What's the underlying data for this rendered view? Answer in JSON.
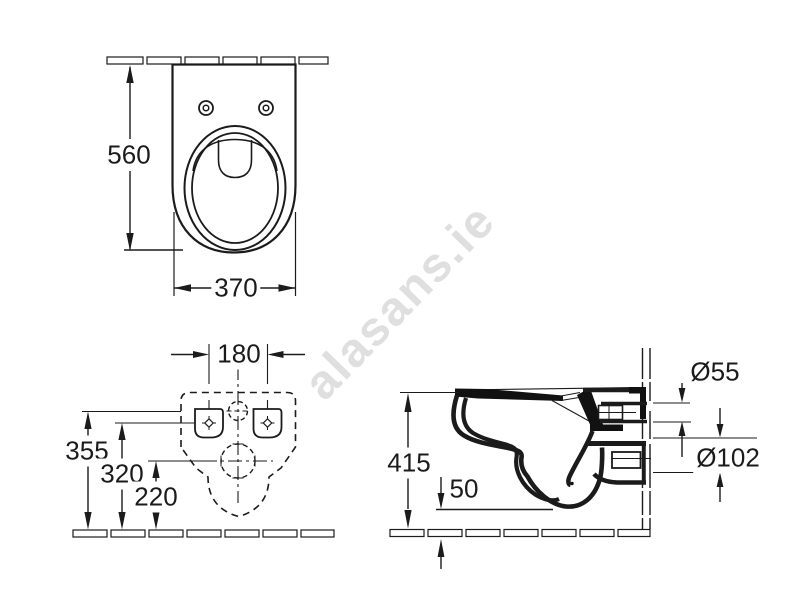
{
  "watermark": {
    "text": "alasans.ie",
    "color": "#dfdfdf"
  },
  "line_color": "#1b1b1b",
  "views": {
    "top": {
      "title": "top-view-of-wall-hung-wc",
      "height": "560",
      "width": "370"
    },
    "rear": {
      "title": "rear-installation-view",
      "fixing_hole_spacing": "180",
      "water_inlet_height": "355",
      "fixing_holes_height": "320",
      "waste_outlet_height": "220"
    },
    "side": {
      "title": "side-section-view",
      "rim_height": "415",
      "bowl_bottom_offset": "50",
      "inlet_diameter": "Ø55",
      "outlet_diameter": "Ø102"
    }
  }
}
